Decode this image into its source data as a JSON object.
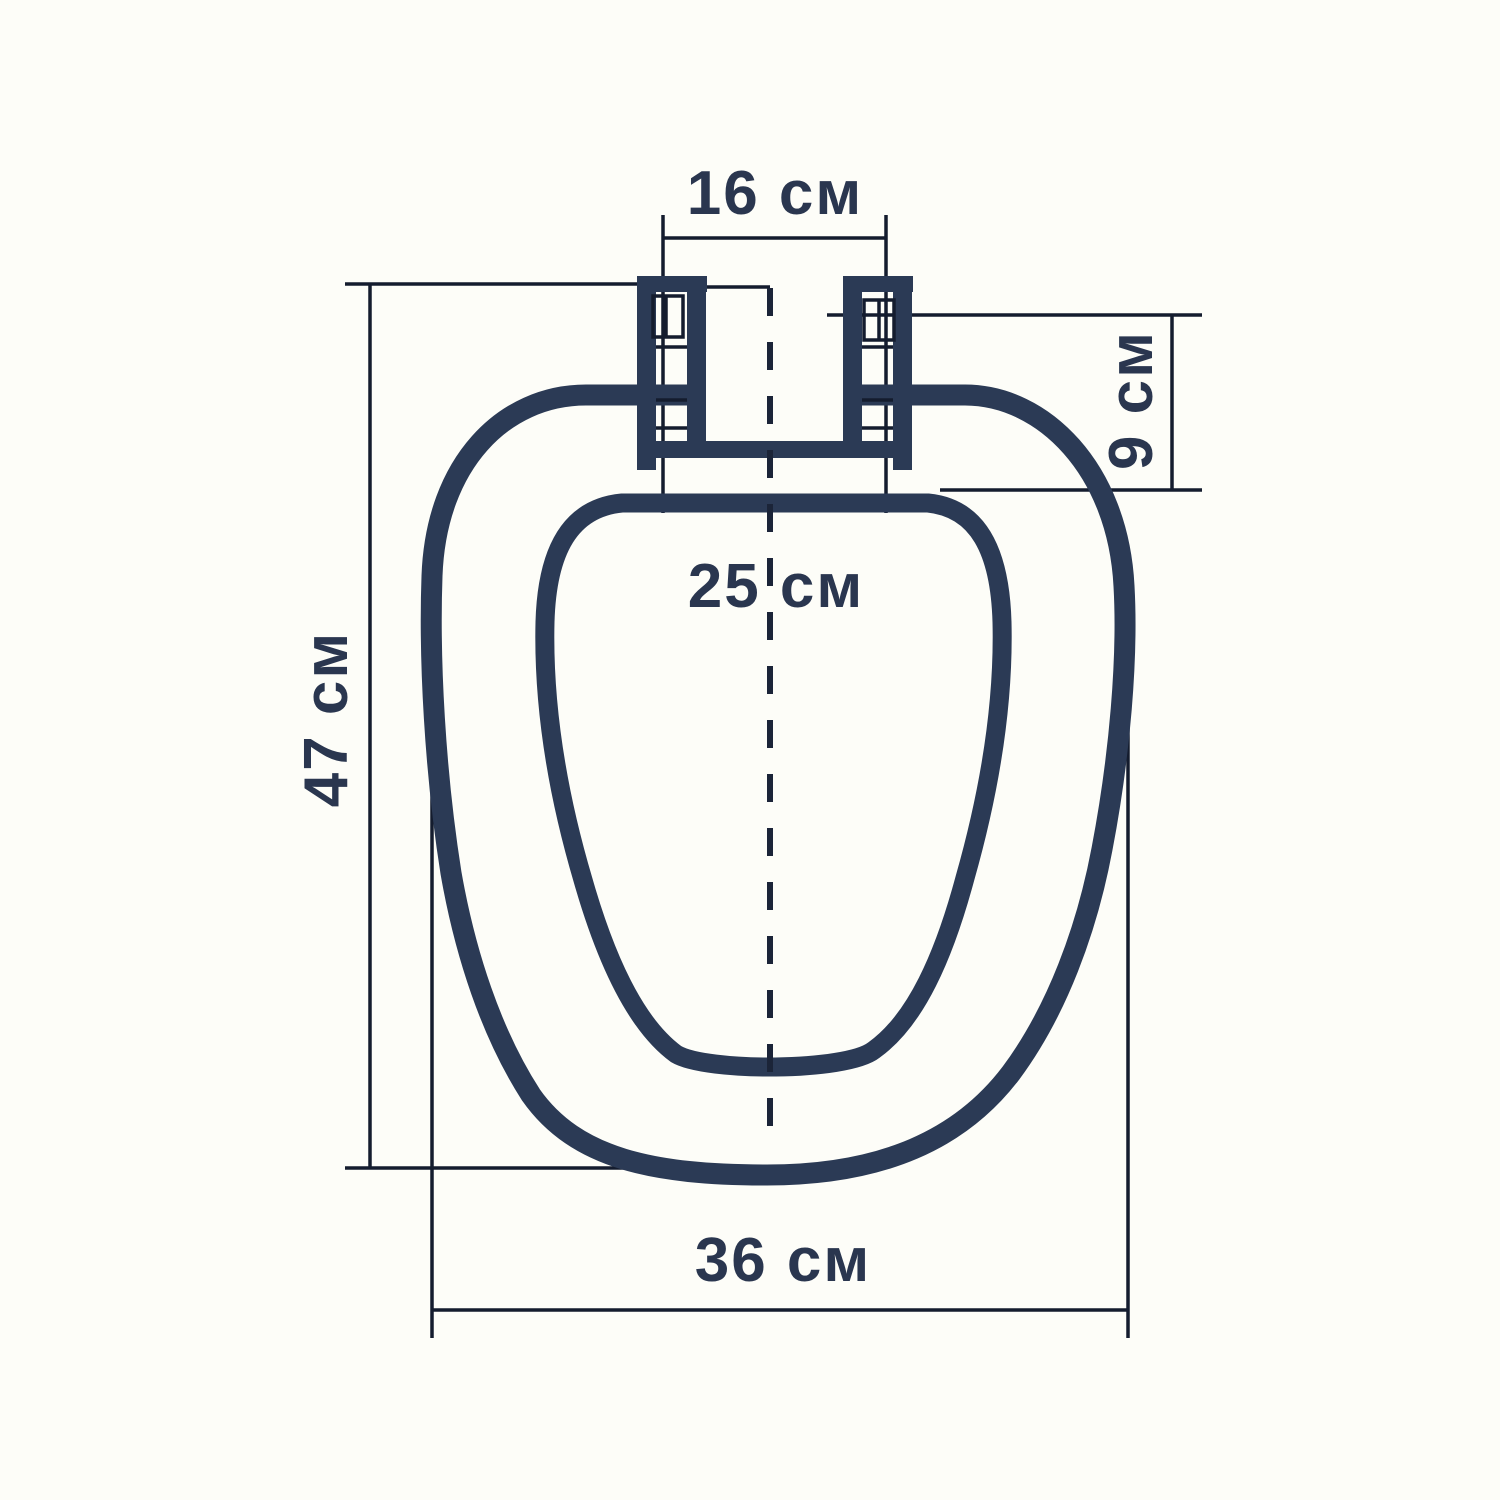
{
  "diagram": {
    "unit_label": "см",
    "colors": {
      "outline": "#2b3a55",
      "thin_line": "#141c2e",
      "dashed_centerline": "#1b2438",
      "text": "#2a364f",
      "paper": "#fdfdf8"
    },
    "dimensions": {
      "hinge_span": {
        "label": "16 см",
        "value_cm": 16
      },
      "hinge_height": {
        "label": "9 см",
        "value_cm": 9
      },
      "overall_length": {
        "label": "47 см",
        "value_cm": 47
      },
      "opening_width": {
        "label": "25 см",
        "value_cm": 25
      },
      "seat_width": {
        "label": "36 см",
        "value_cm": 36
      }
    }
  }
}
